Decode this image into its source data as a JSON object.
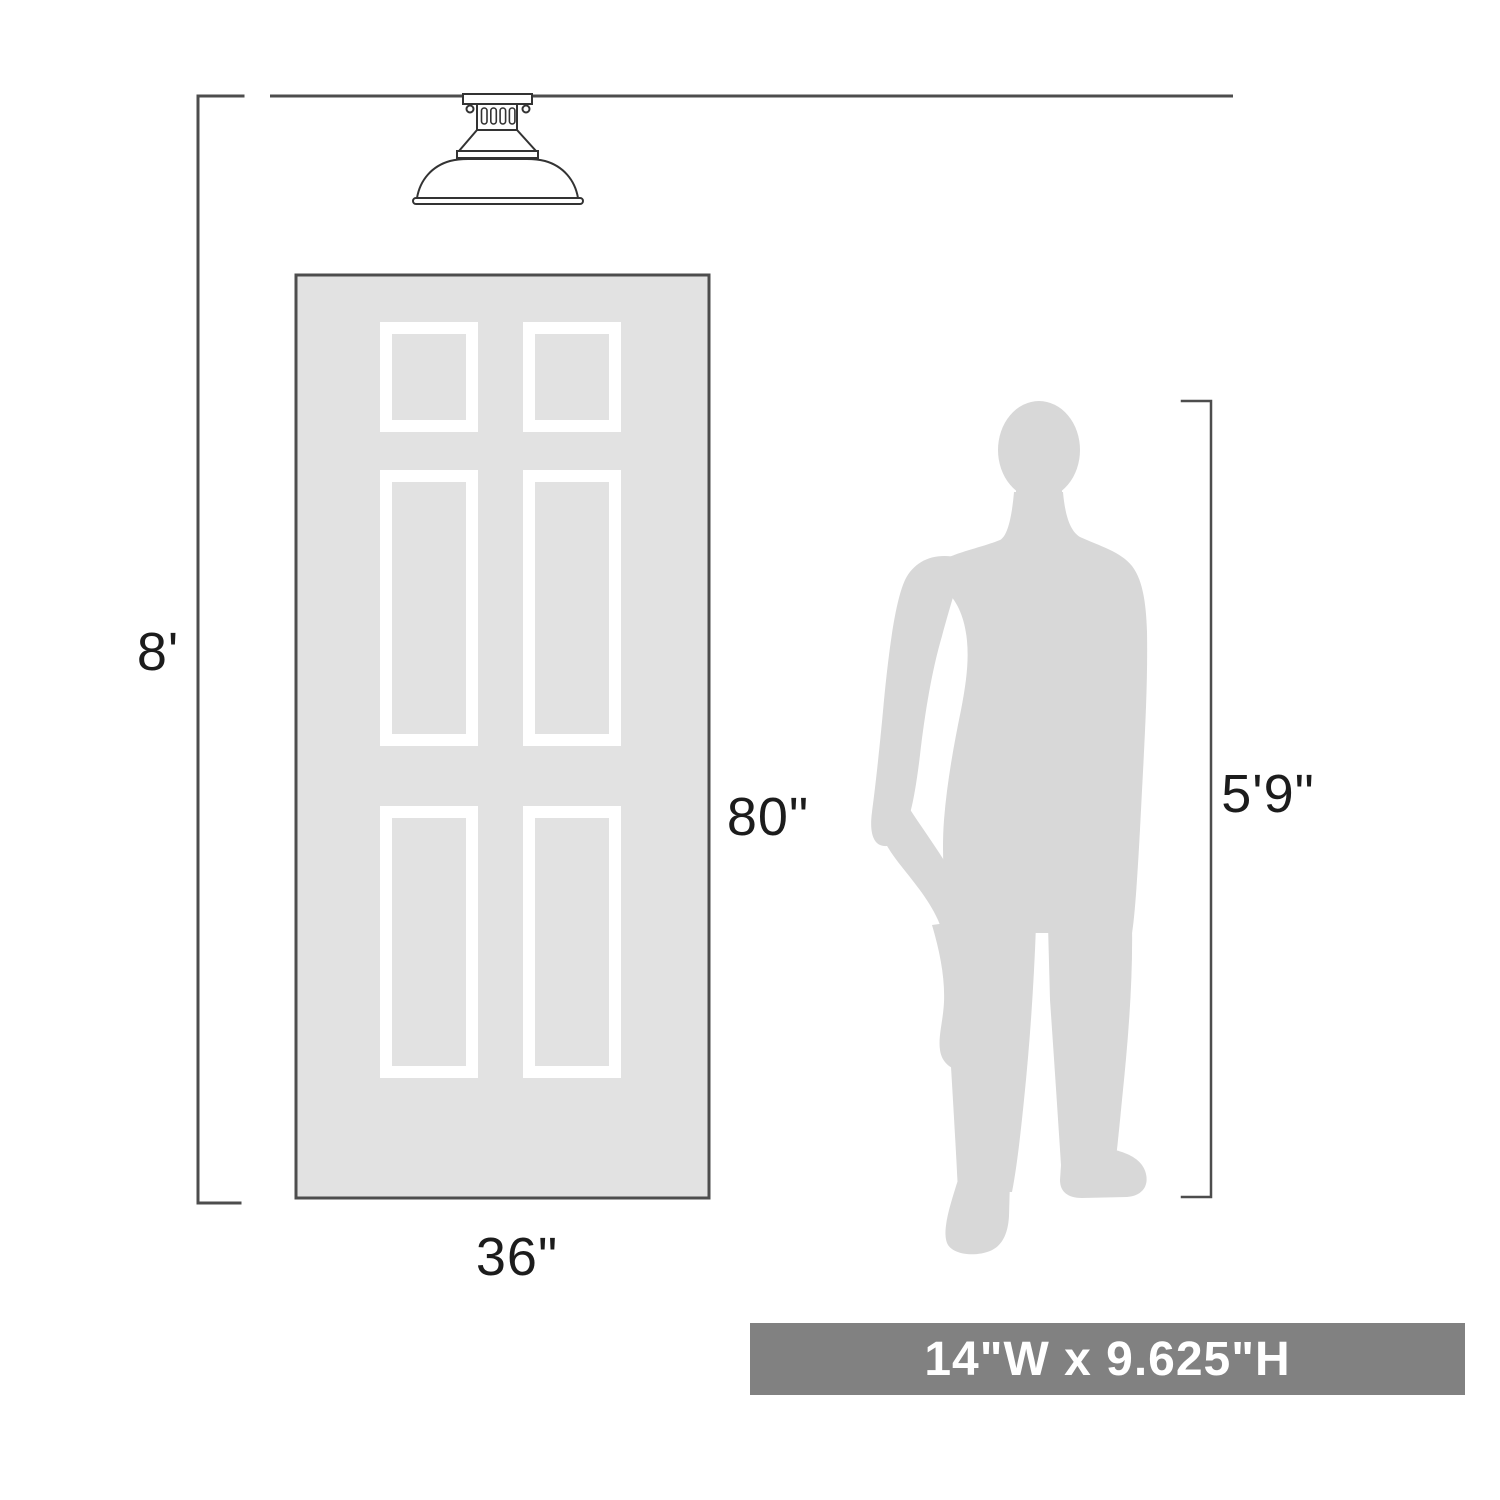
{
  "labels": {
    "ceiling_height": "8'",
    "door_height": "80\"",
    "door_width": "36\"",
    "person_height": "5'9\""
  },
  "banner": {
    "text": "14\"W x 9.625\"H"
  },
  "illustrations": [
    "ceiling-line",
    "flush-mount-light-fixture",
    "six-panel-door",
    "man-silhouette",
    "ceiling-height-bracket",
    "person-height-bracket"
  ],
  "colors": {
    "line": "#4d4d4d",
    "fixture_outline": "#333333",
    "door_fill": "#e2e2e2",
    "door_border": "#4d4d4d",
    "panel_frame": "#ffffff",
    "silhouette": "#d8d8d8",
    "banner_bg": "#818181",
    "banner_text": "#ffffff",
    "label_text": "#1c1c1c",
    "background": "#ffffff"
  }
}
